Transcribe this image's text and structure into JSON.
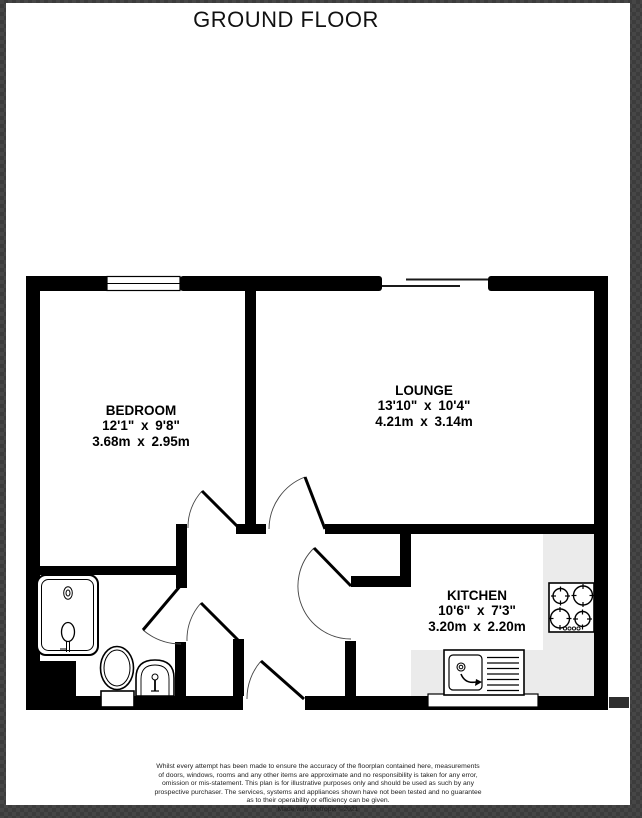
{
  "page": {
    "title": "GROUND FLOOR"
  },
  "rooms": [
    {
      "name": "BEDROOM",
      "imperial": "12'1\" x 9'8\"",
      "metric": "3.68m x 2.95m"
    },
    {
      "name": "LOUNGE",
      "imperial": "13'10\" x 10'4\"",
      "metric": "4.21m x 3.14m"
    },
    {
      "name": "KITCHEN",
      "imperial": "10'6\" x 7'3\"",
      "metric": "3.20m x 2.20m"
    }
  ],
  "footer": {
    "lines": [
      "Whilst every attempt has been made to ensure the accuracy of the floorplan contained here, measurements",
      "of doors, windows, rooms and any other items are approximate and no responsibility is taken for any error,",
      "omission or mis-statement. This plan is for illustrative purposes only and should be used as such by any",
      "prospective purchaser. The services, systems and appliances shown have not been tested and no guarantee",
      "as to their operability or efficiency can be given."
    ],
    "credit": "Made with Metropix ©2021"
  },
  "colors": {
    "wall": "#000000",
    "worktop": "#ebebeb",
    "paper": "#ffffff",
    "frame": "#414141",
    "door_arc": "#444444"
  },
  "windows": [
    "bedroom-window",
    "patio-sliding-door"
  ],
  "doors": [
    "bedroom-door",
    "lounge-door",
    "kitchen-door",
    "bathroom-door",
    "cupboard-door",
    "entrance-door"
  ],
  "fixtures": [
    "shower",
    "toilet",
    "basin",
    "hob",
    "sink-drainer",
    "worktop"
  ]
}
